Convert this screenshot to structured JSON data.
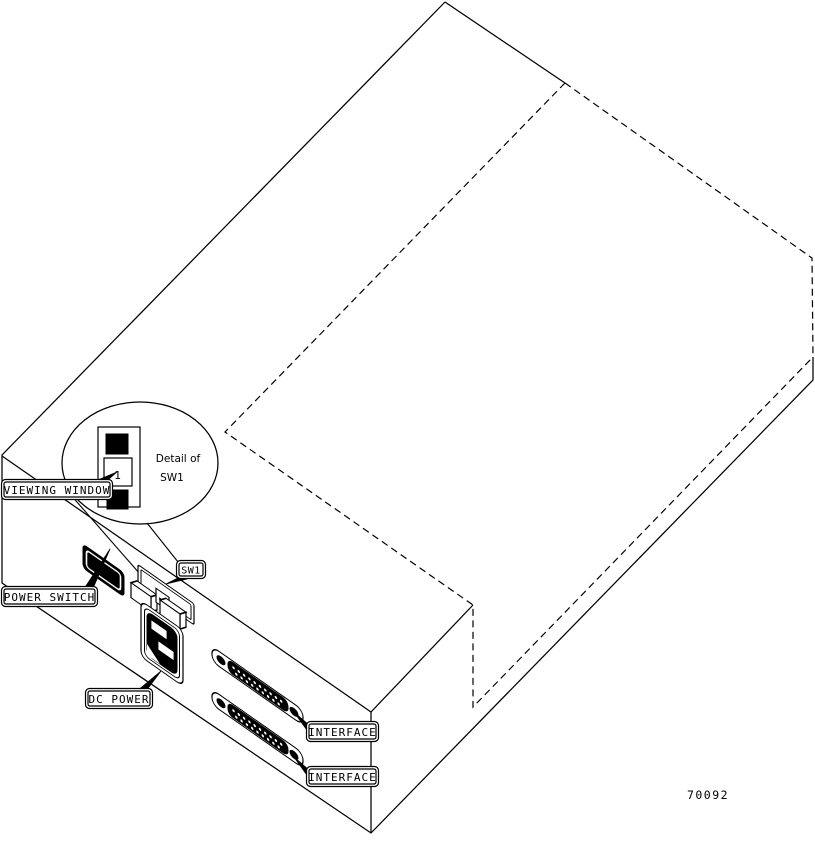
{
  "figure_number": "70092",
  "labels": {
    "viewing_window": "VIEWING WINDOW",
    "power_switch": "POWER SWITCH",
    "sw1": "SW1",
    "dc_power": "DC POWER",
    "interface": [
      "INTERFACE",
      "INTERFACE"
    ]
  },
  "detail": {
    "caption_line1": "Detail of",
    "caption_line2": "SW1",
    "window_digit": "1"
  },
  "colors": {
    "line": "#000000",
    "background": "#ffffff"
  }
}
